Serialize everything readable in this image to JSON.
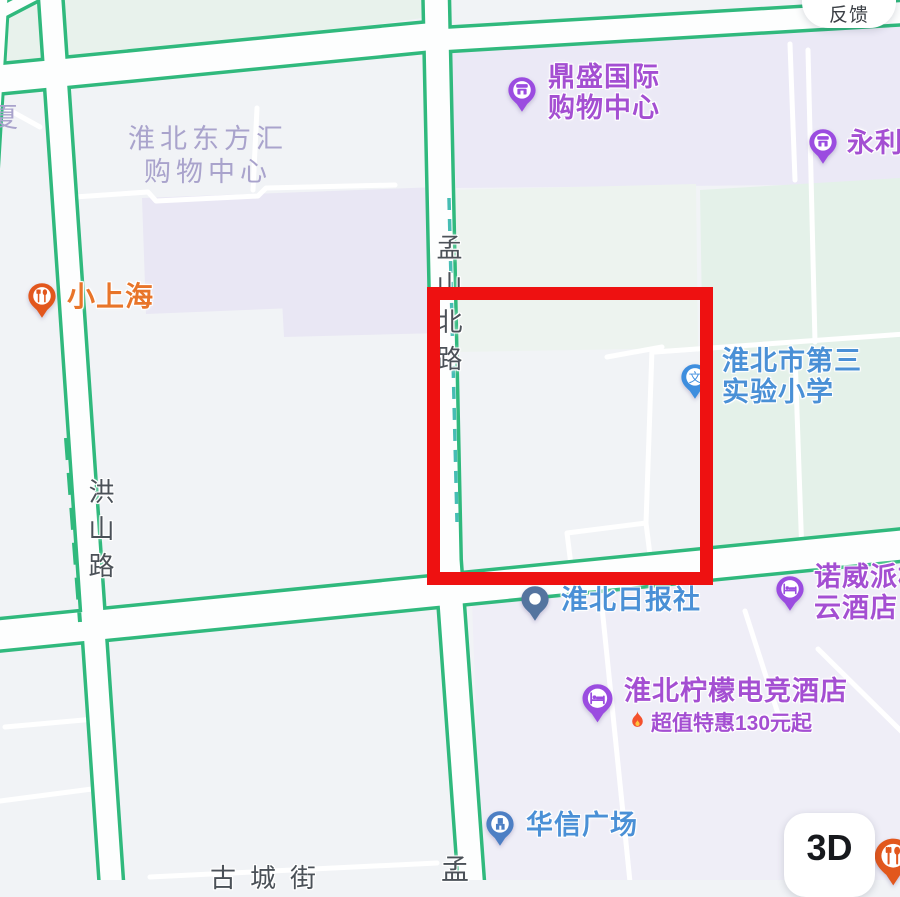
{
  "ui": {
    "feedback_button_label": "反馈",
    "view_3d_button_label": "3D"
  },
  "annotation": {
    "shape": "rectangle",
    "color": "#ee1111"
  },
  "road_labels": {
    "mengshan_north_road": "孟山北路",
    "hongshan_road": "洪山路",
    "meng_partial": "孟",
    "gucheng_street": "古城街"
  },
  "area_labels": {
    "dongfanghui_line1": "淮北东方汇",
    "dongfanghui_line2": "购物中心",
    "xia_partial": "夏"
  },
  "pois": [
    {
      "id": "dingsheng",
      "lines": [
        "鼎盛国际",
        "购物中心"
      ],
      "icon": "shop",
      "pin_color": "#9b4ce0",
      "text_color": "#a44fd2"
    },
    {
      "id": "yongli",
      "lines": [
        "永利"
      ],
      "icon": "shop",
      "pin_color": "#9b4ce0",
      "text_color": "#a44fd2"
    },
    {
      "id": "xiaoshanghai",
      "lines": [
        "小上海"
      ],
      "icon": "food",
      "pin_color": "#e2571d",
      "text_color": "#e8752a"
    },
    {
      "id": "school",
      "lines": [
        "淮北市第三",
        "实验小学"
      ],
      "icon": "school",
      "pin_color": "#3e8ede",
      "text_color": "#4a90d6"
    },
    {
      "id": "daily",
      "lines": [
        "淮北日报社"
      ],
      "icon": "dot",
      "pin_color": "#54749f",
      "text_color": "#4a90d6"
    },
    {
      "id": "nuowei",
      "lines": [
        "诺威派柏",
        "云酒店"
      ],
      "icon": "bed",
      "pin_color": "#9b4ce0",
      "text_color": "#a44fd2"
    },
    {
      "id": "lemon",
      "lines": [
        "淮北柠檬电竞酒店"
      ],
      "icon": "bed",
      "pin_color": "#9b4ce0",
      "text_color": "#a44fd2",
      "promo": "超值特惠130元起",
      "promo_icon": "flame"
    },
    {
      "id": "huaxin",
      "lines": [
        "华信广场"
      ],
      "icon": "building",
      "pin_color": "#4d7fc4",
      "text_color": "#4a90d6"
    },
    {
      "id": "corner_food",
      "lines": [],
      "icon": "food",
      "pin_color": "#e2571d",
      "text_color": "#e8752a"
    }
  ],
  "colors": {
    "background": "#f1f3f6",
    "road_casing_green": "#30b97d",
    "road_fill": "#fdfefe",
    "building_block_lavender": "#e9e7f4",
    "park_green": "#e4f1e9",
    "dashed_lane_teal": "#46bdb4"
  }
}
